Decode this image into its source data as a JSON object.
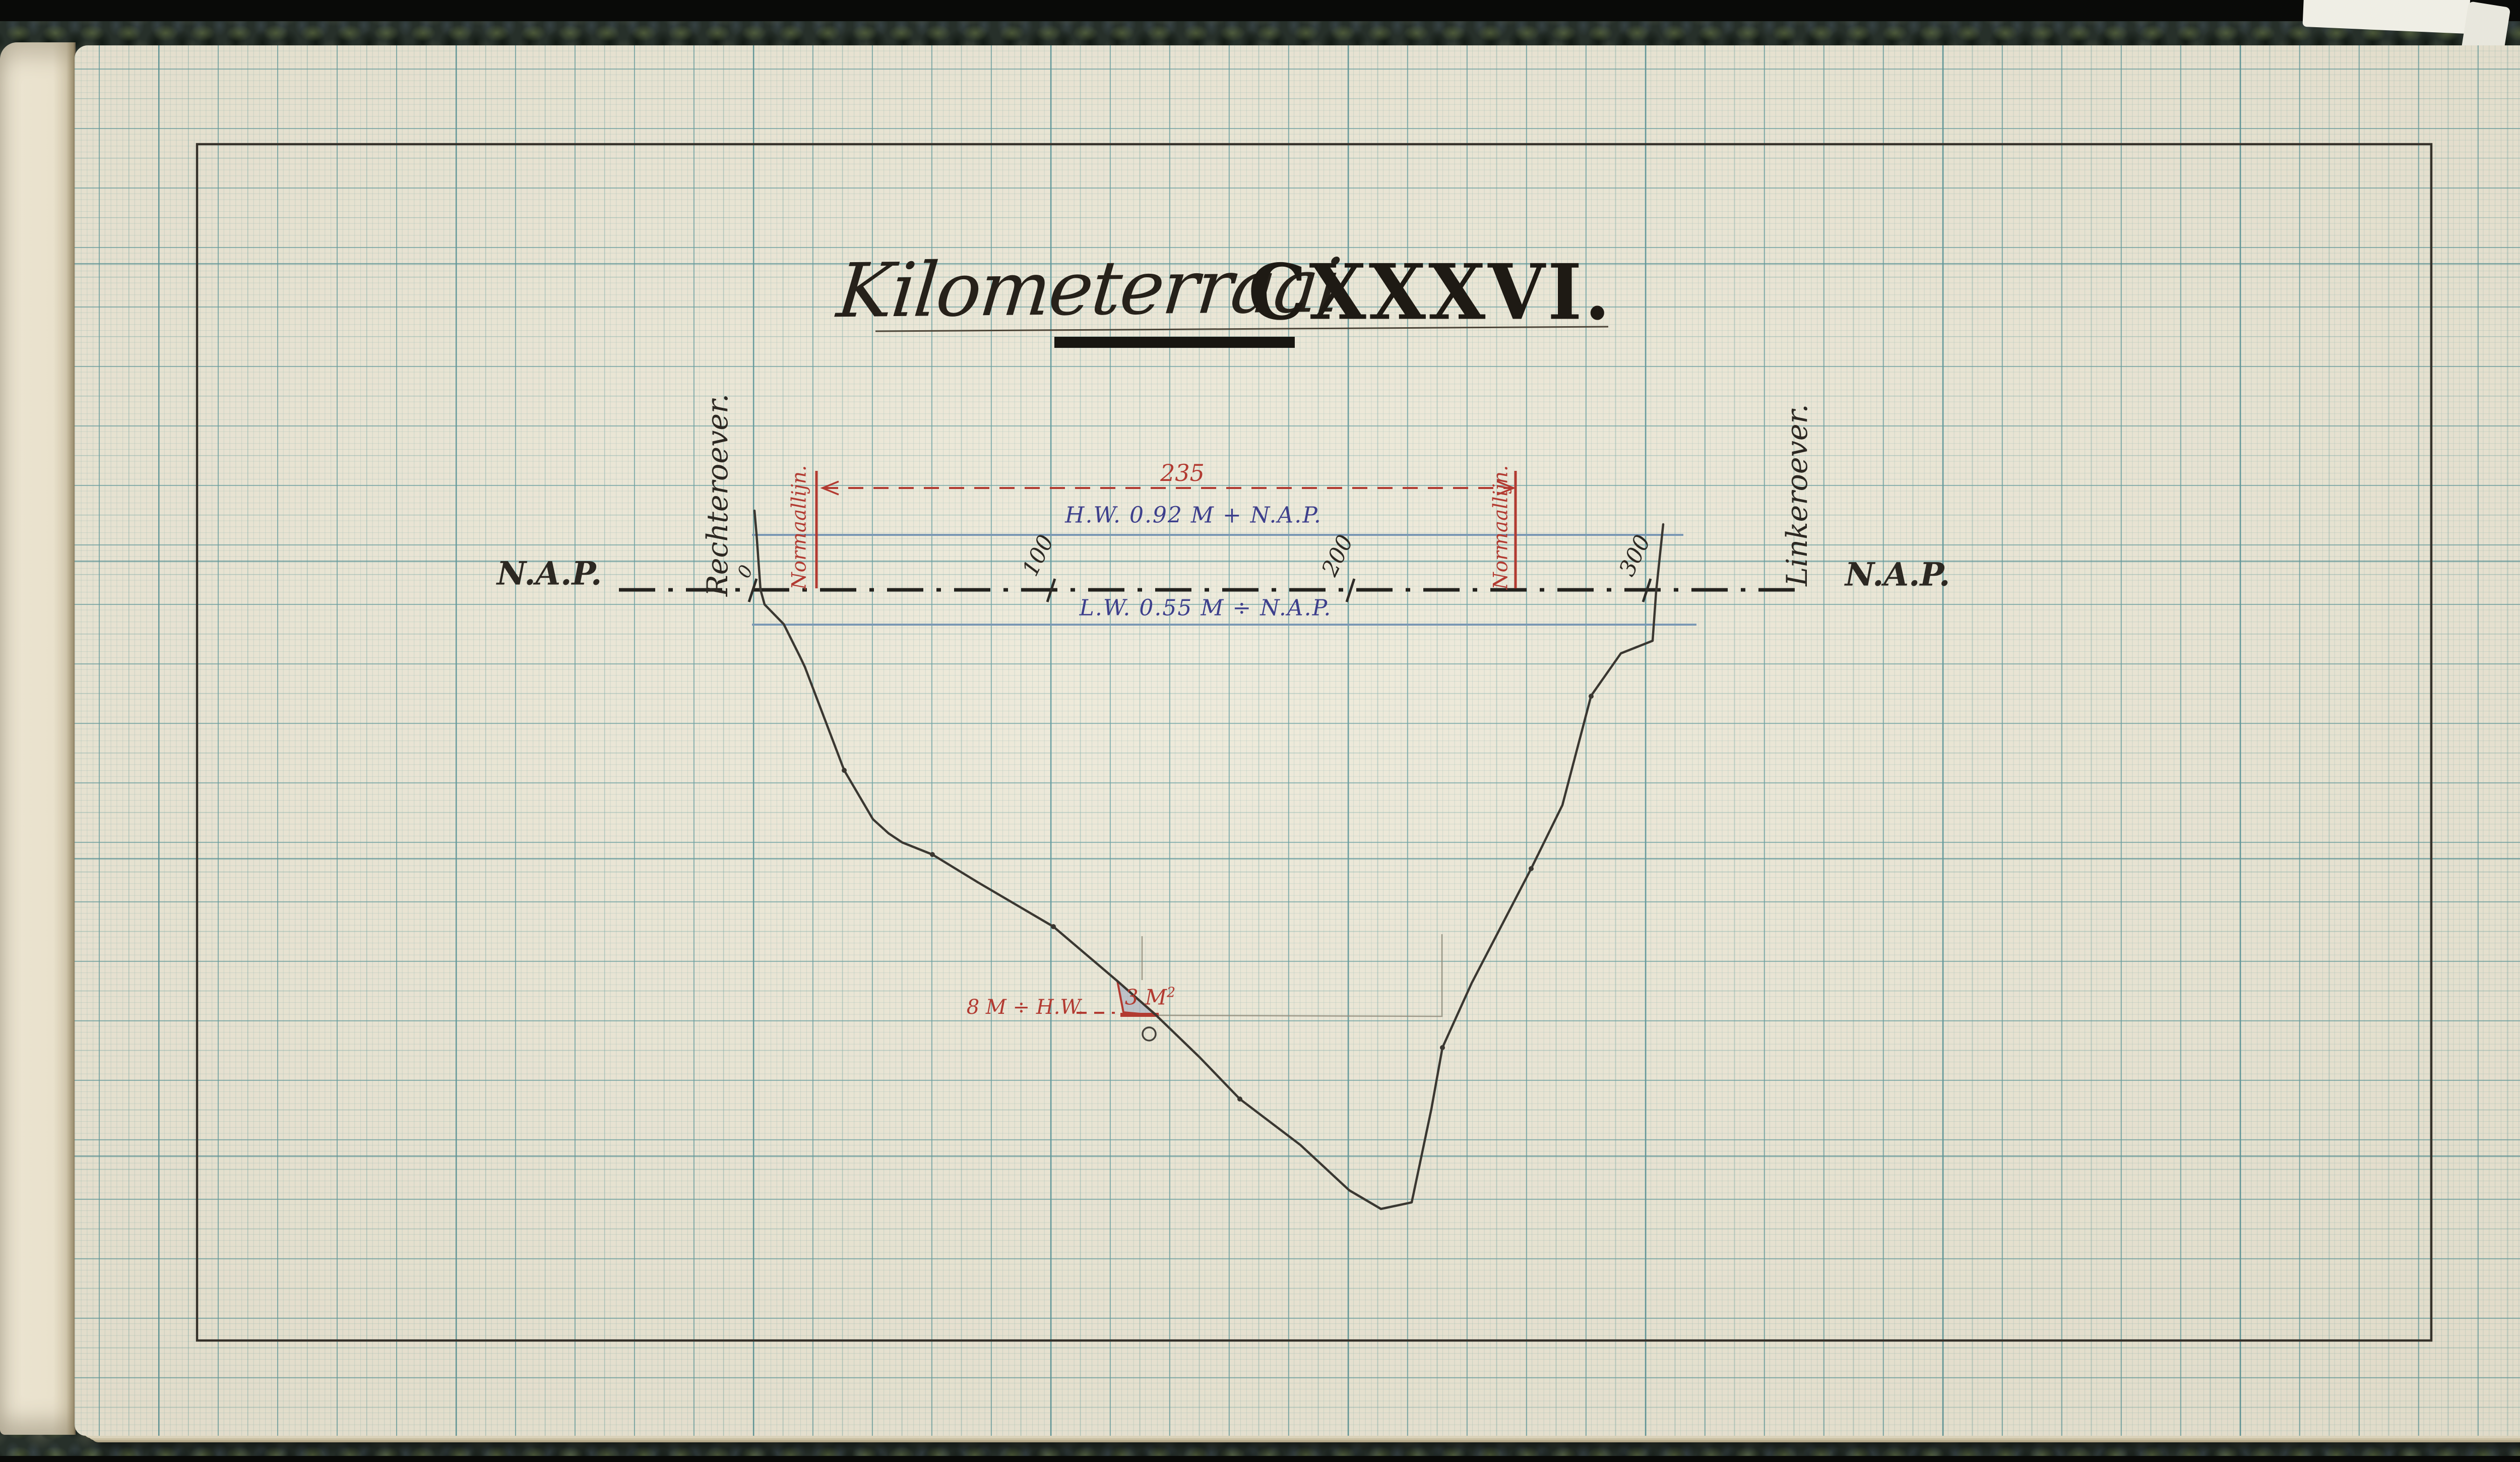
{
  "title": {
    "script": "Kilometerraai",
    "roman": "CXXXVI."
  },
  "banks": {
    "right_bank": "Rechteroever.",
    "left_bank": "Linkeroever."
  },
  "datum": {
    "left": "N.A.P.",
    "right": "N.A.P."
  },
  "scale_ticks": [
    {
      "label": "0"
    },
    {
      "label": "100"
    },
    {
      "label": "200"
    },
    {
      "label": "300"
    }
  ],
  "water_levels": {
    "high": "H.W. 0.92 M + N.A.P.",
    "low": "L.W. 0.55 M ÷ N.A.P."
  },
  "normal_lines": {
    "left": "Normaallijn.",
    "right": "Normaallijn.",
    "span": "235"
  },
  "depth_annotation": {
    "depth": "8 M ÷ H.W.",
    "area": "3 M",
    "area_sup": "2"
  },
  "colors": {
    "red_ink": "#b23a31",
    "blue_ink": "#3d3f8c",
    "water_line": "#7a98b4",
    "black_ink": "#2e2b26",
    "pencil": "#8f8b7a",
    "paper": "#ebe7d7",
    "grid_teal": "#4a8d94"
  },
  "drawing": {
    "frame_d": "M391 286 H4824 V2659 H391 Z",
    "nap_d": "M1228 1170 H3582",
    "hw_d": "M1492 1061 H3340",
    "lw_d": "M1492 1239 H3366",
    "span_d": "M1633 968 H3002",
    "arrow_left_d": "M1664 955 L1632 968 L1664 981",
    "arrow_right_d": "M2971 955 L3003 968 L2971 981",
    "normals_d": "M1620 934 V1167 M3007 934 V1167",
    "ticks_d": "M1501 1148 L1486 1194 M2093 1148 L2078 1194 M2687 1148 L2672 1194 M3275 1148 L3260 1194",
    "title_rule_d": "M1737 657 L3191 648",
    "title_bar_d": "M2092 679 H2569",
    "depth_dash_d": "M2136 2009 H2212",
    "triangle_d": "M2217 1946 L2229 2008 L2295 2014 Z",
    "triangle_base_d": "M2223 2013 H2299",
    "pencil_d": "M2296 2014 L2861 2016 L2861 1853 M2266 1857 L2266 1944",
    "sounding_circle_d": "M2267 2051 a13 13 0 1 0 26 0 a13 13 0 1 0 -26 0",
    "survey_dots_d": "M1670 1528 a5 5 0 1 0 10 0 a5 5 0 1 0 -10 0 M1845 1695 a5 5 0 1 0 10 0 a5 5 0 1 0 -10 0 M2085 1838 a5 5 0 1 0 10 0 a5 5 0 1 0 -10 0 M2455 2180 a5 5 0 1 0 10 0 a5 5 0 1 0 -10 0 M2857 2078 a5 5 0 1 0 10 0 a5 5 0 1 0 -10 0 M3033 1723 a5 5 0 1 0 10 0 a5 5 0 1 0 -10 0 M3152 1381 a5 5 0 1 0 10 0 a5 5 0 1 0 -10 0",
    "profile_points": "1497,1013 1501,1059 1509,1170 1517,1199 1555,1238 1587,1302 1597,1323 1675,1528 1732,1625 1763,1653 1790,1671 1850,1695 1940,1750 2090,1838 2217,1946 2293,2013 2380,2097 2460,2180 2580,2271 2677,2361 2740,2398 2801,2385 2840,2200 2862,2078 2920,1950 3038,1723 3100,1597 3157,1380 3216,1296 3279,1271 3286,1173 3300,1040"
  }
}
